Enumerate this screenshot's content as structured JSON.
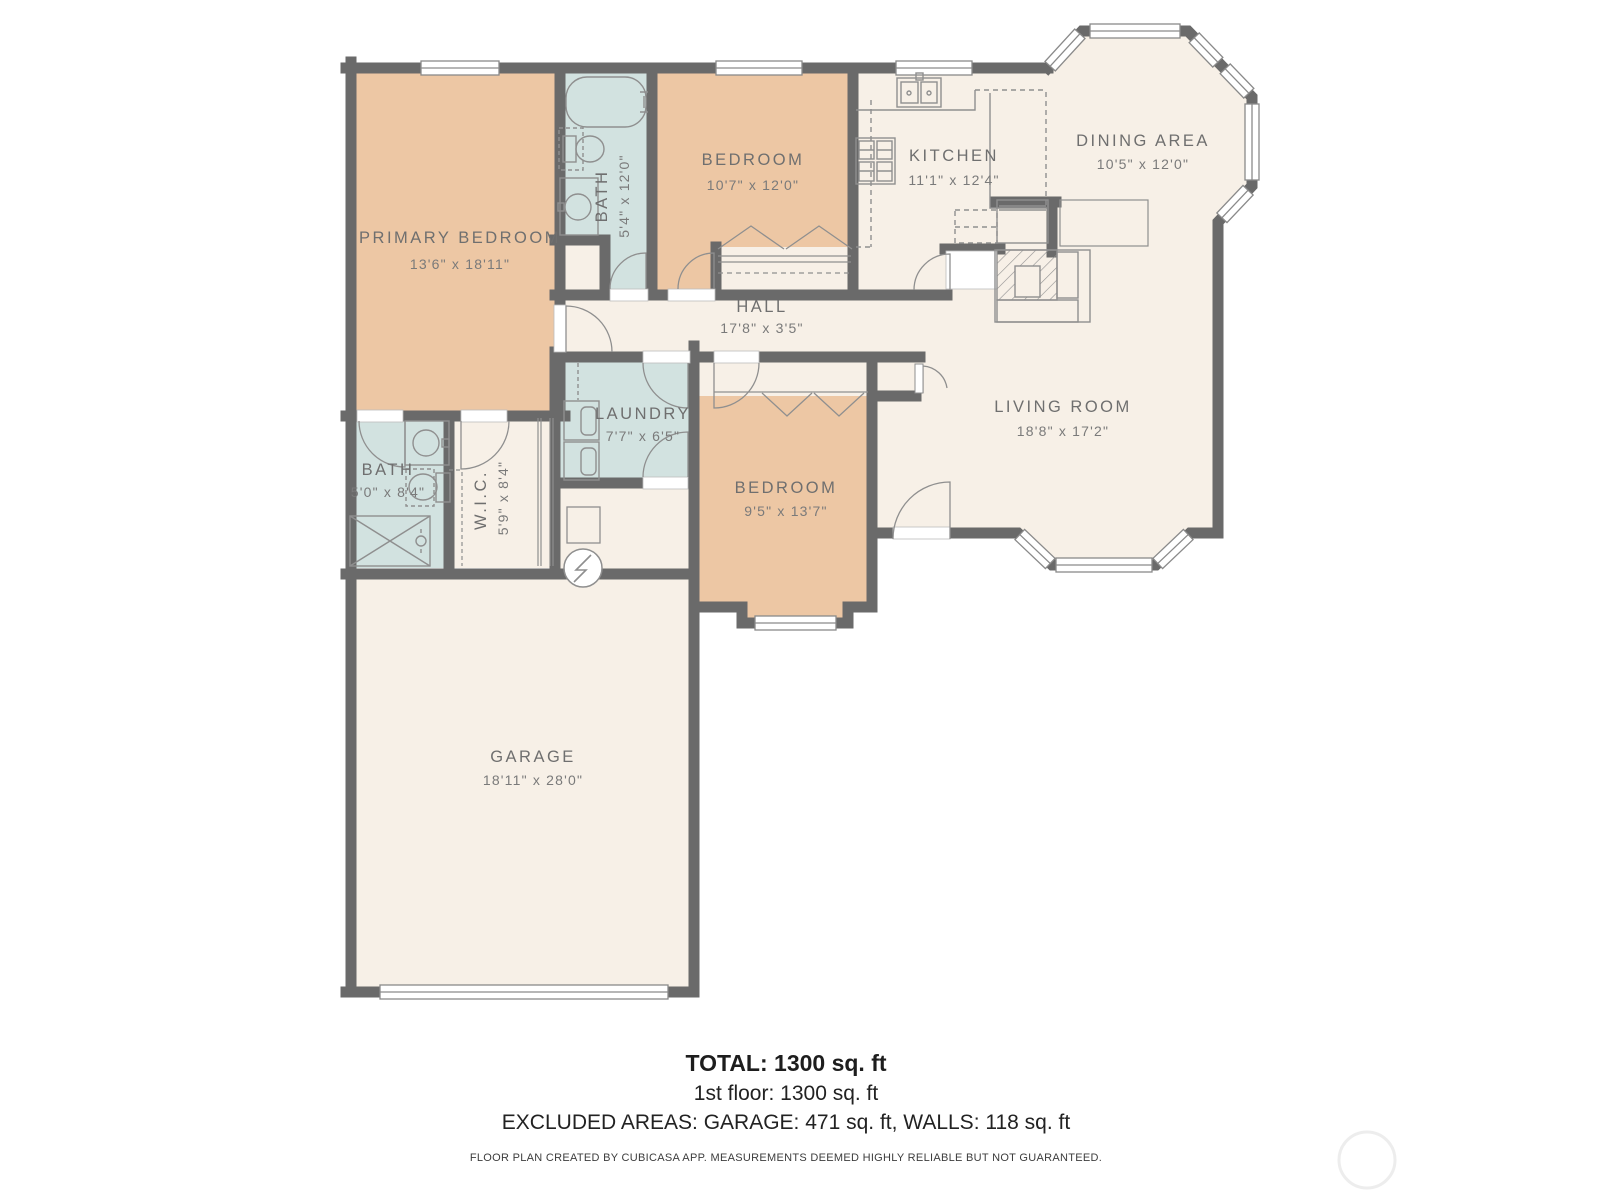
{
  "rooms": {
    "primary_bedroom": {
      "name": "PRIMARY BEDROOM",
      "dims": "13'6\" x 18'11\""
    },
    "bath1": {
      "name": "BATH",
      "dims": "5'4\" x 12'0\""
    },
    "bedroom1": {
      "name": "BEDROOM",
      "dims": "10'7\" x 12'0\""
    },
    "kitchen": {
      "name": "KITCHEN",
      "dims": "11'1\" x 12'4\""
    },
    "dining": {
      "name": "DINING AREA",
      "dims": "10'5\" x 12'0\""
    },
    "hall": {
      "name": "HALL",
      "dims": "17'8\" x 3'5\""
    },
    "living": {
      "name": "LIVING ROOM",
      "dims": "18'8\" x 17'2\""
    },
    "laundry": {
      "name": "LAUNDRY",
      "dims": "7'7\" x 6'5\""
    },
    "bedroom2": {
      "name": "BEDROOM",
      "dims": "9'5\" x 13'7\""
    },
    "bath2": {
      "name": "BATH",
      "dims": "5'0\" x 8'4\""
    },
    "wic": {
      "name": "W.I.C.",
      "dims": "5'9\" x 8'4\""
    },
    "garage": {
      "name": "GARAGE",
      "dims": "18'11\" x 28'0\""
    }
  },
  "summary": {
    "total": "TOTAL: 1300 sq. ft",
    "first_floor": "1st floor: 1300 sq. ft",
    "excluded": "EXCLUDED AREAS: GARAGE: 471 sq. ft, WALLS: 118 sq. ft",
    "disclaimer": "FLOOR PLAN CREATED BY CUBICASA APP. MEASUREMENTS DEEMED HIGHLY RELIABLE BUT NOT GUARANTEED."
  },
  "colors": {
    "wall": "#6a6a6a",
    "bedroom_fill": "#edc7a4",
    "wet_room_fill": "#d2e2e0",
    "floor_fill": "#f7f0e7",
    "label_text": "#6f6f6f",
    "fixture_stroke": "#8f8f8f",
    "summary_text": "#1d1d1d"
  }
}
